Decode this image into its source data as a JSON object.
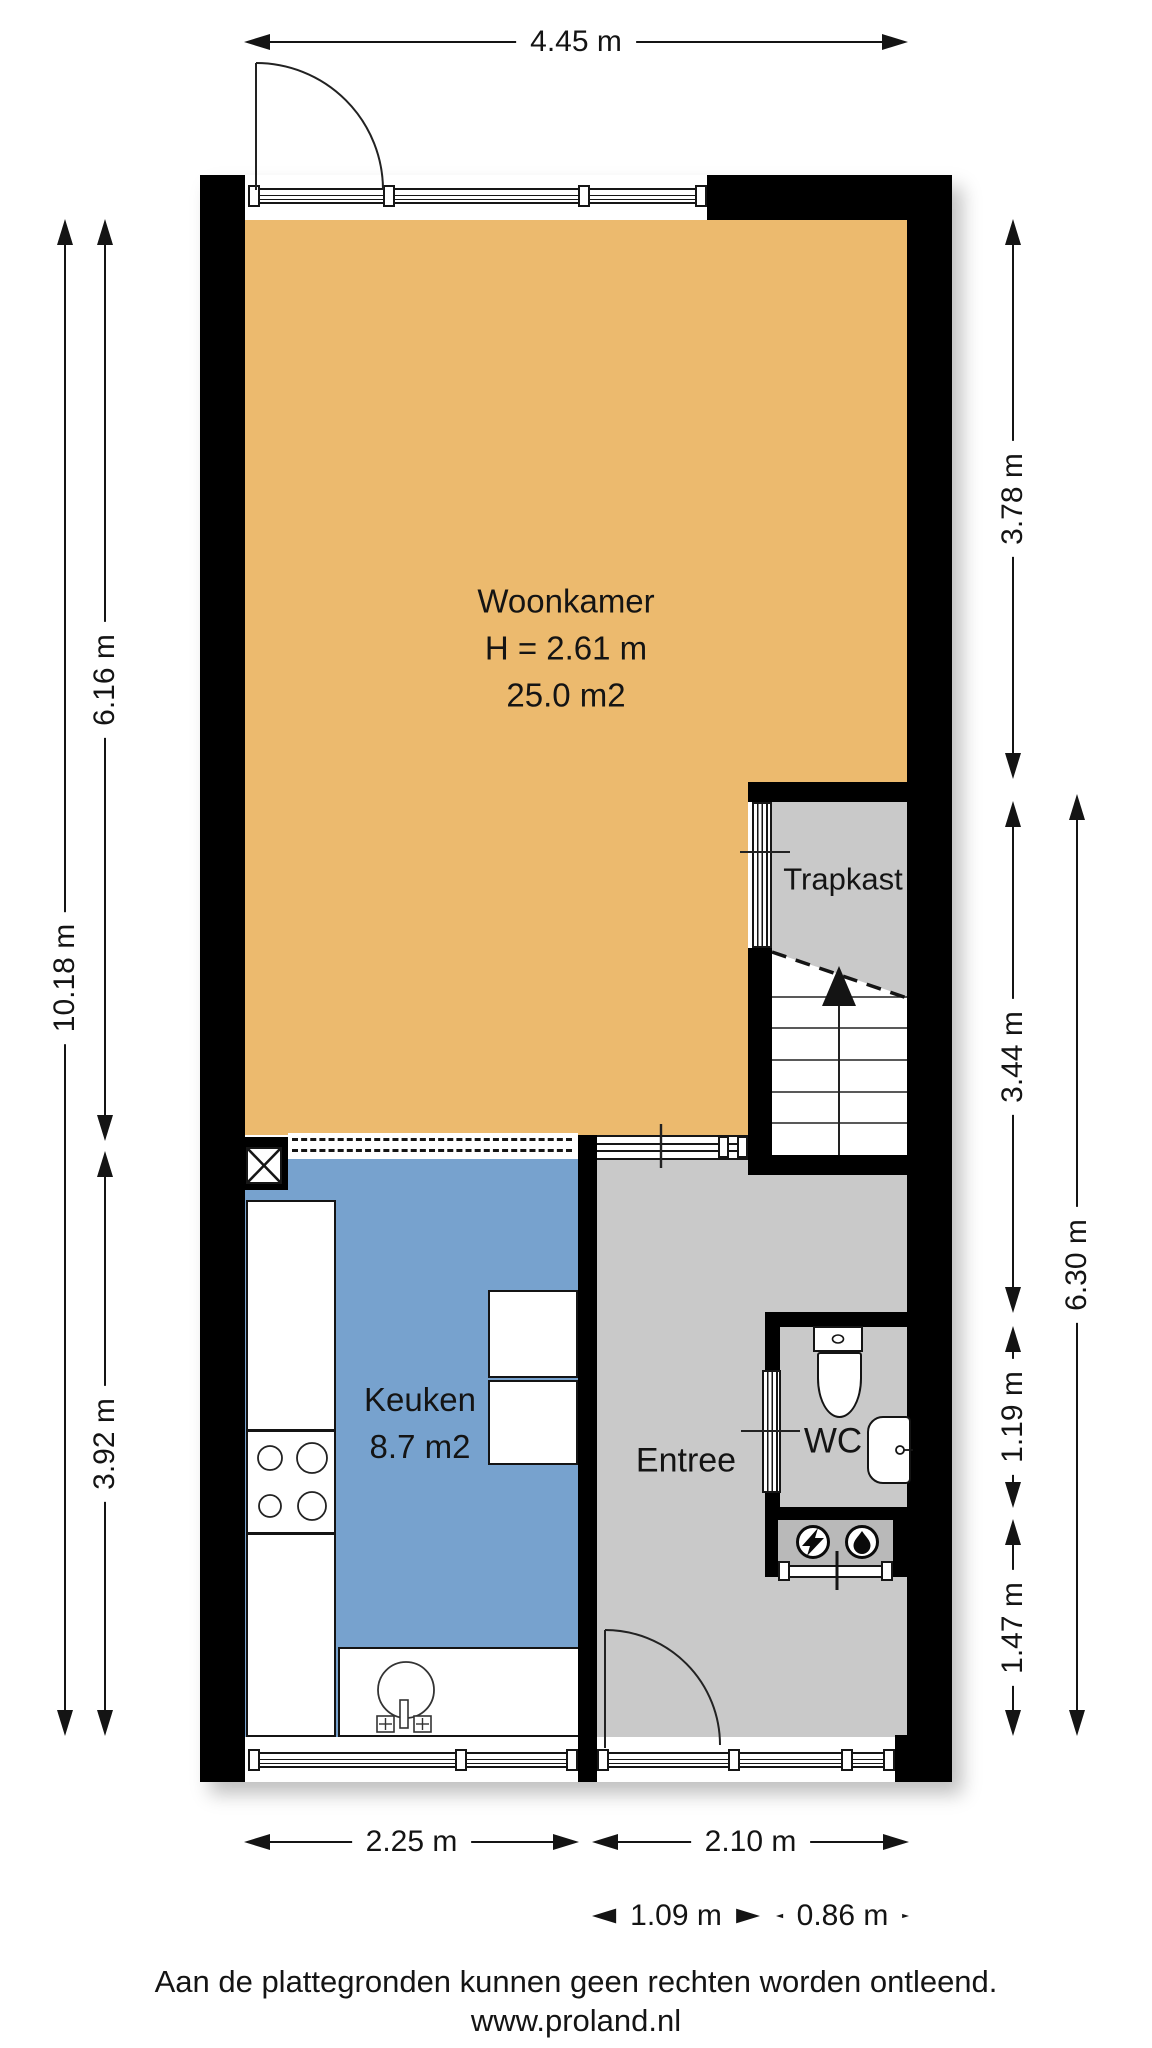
{
  "floorplan": {
    "rooms": {
      "woonkamer": {
        "name": "Woonkamer",
        "ceiling_height": "H = 2.61 m",
        "area": "25.0 m2"
      },
      "trapkast": {
        "name": "Trapkast"
      },
      "keuken": {
        "name": "Keuken",
        "area": "8.7 m2"
      },
      "entree": {
        "name": "Entree"
      },
      "wc": {
        "name": "WC"
      }
    },
    "dimensions": {
      "top_width": "4.45 m",
      "left_total": "10.18 m",
      "left_upper": "6.16 m",
      "left_lower": "3.92 m",
      "right_upper": "3.78 m",
      "right_stair_section": "3.44 m",
      "right_lower_total": "6.30 m",
      "right_wc": "1.19 m",
      "right_below_wc": "1.47 m",
      "bottom_keuken": "2.25 m",
      "bottom_entree": "2.10 m",
      "bottom_entree_door": "1.09 m",
      "bottom_entree_window": "0.86 m"
    },
    "icons": [
      "stairs-up-arrow-icon",
      "electric-meter-icon",
      "water-meter-icon",
      "duct-cross-icon"
    ],
    "colors": {
      "woonkamer": "#ECBA6E",
      "keuken": "#77A2CE",
      "hal": "#C9C9C9",
      "meterkast": "#B9B9B9",
      "wall": "#000000",
      "ink": "#141414"
    }
  },
  "footer": {
    "disclaimer": "Aan de plattegronden kunnen geen rechten worden ontleend.",
    "website": "www.proland.nl"
  }
}
